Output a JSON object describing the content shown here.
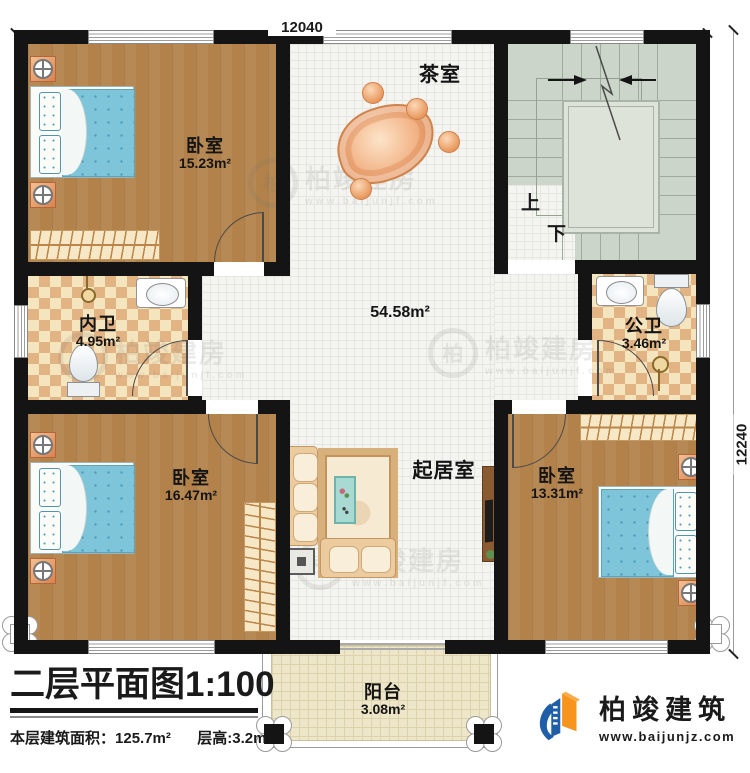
{
  "dimensions": {
    "top": "12040",
    "right": "12240"
  },
  "rooms": {
    "bedroom_tl": {
      "name": "卧室",
      "area": "15.23m²"
    },
    "tearoom": {
      "name": "茶室"
    },
    "hall": {
      "area": "54.58m²"
    },
    "bath_inner": {
      "name": "内卫",
      "area": "4.95m²"
    },
    "bath_public": {
      "name": "公卫",
      "area": "3.46m²"
    },
    "bedroom_bl": {
      "name": "卧室",
      "area": "16.47m²"
    },
    "living": {
      "name": "起居室"
    },
    "bedroom_br": {
      "name": "卧室",
      "area": "13.31m²"
    },
    "balcony": {
      "name": "阳台",
      "area": "3.08m²"
    }
  },
  "stairs": {
    "up_label": "上",
    "down_label": "下"
  },
  "title_block": {
    "title": "二层平面图",
    "scale": "1:100",
    "floor_area_label": "本层建筑面积：",
    "floor_area_value": "125.7m²",
    "story_height_label": "层高:",
    "story_height_value": "3.2m"
  },
  "logo": {
    "company": "柏竣建筑",
    "website": "www.baijunjz.com"
  },
  "watermark": {
    "glyph": "柏",
    "text": "柏竣建房",
    "url": "www.baijunjf.com"
  },
  "colors": {
    "wall": "#141414",
    "wood": "#b2824a",
    "tile": "#f4f4f0",
    "checker_tan": "#e2b383",
    "stair": "#ccd5c9",
    "balcony": "#ede6c9",
    "bed": "#7ec5da",
    "logo_blue": "#1f5fa8",
    "logo_orange": "#f7941d"
  }
}
